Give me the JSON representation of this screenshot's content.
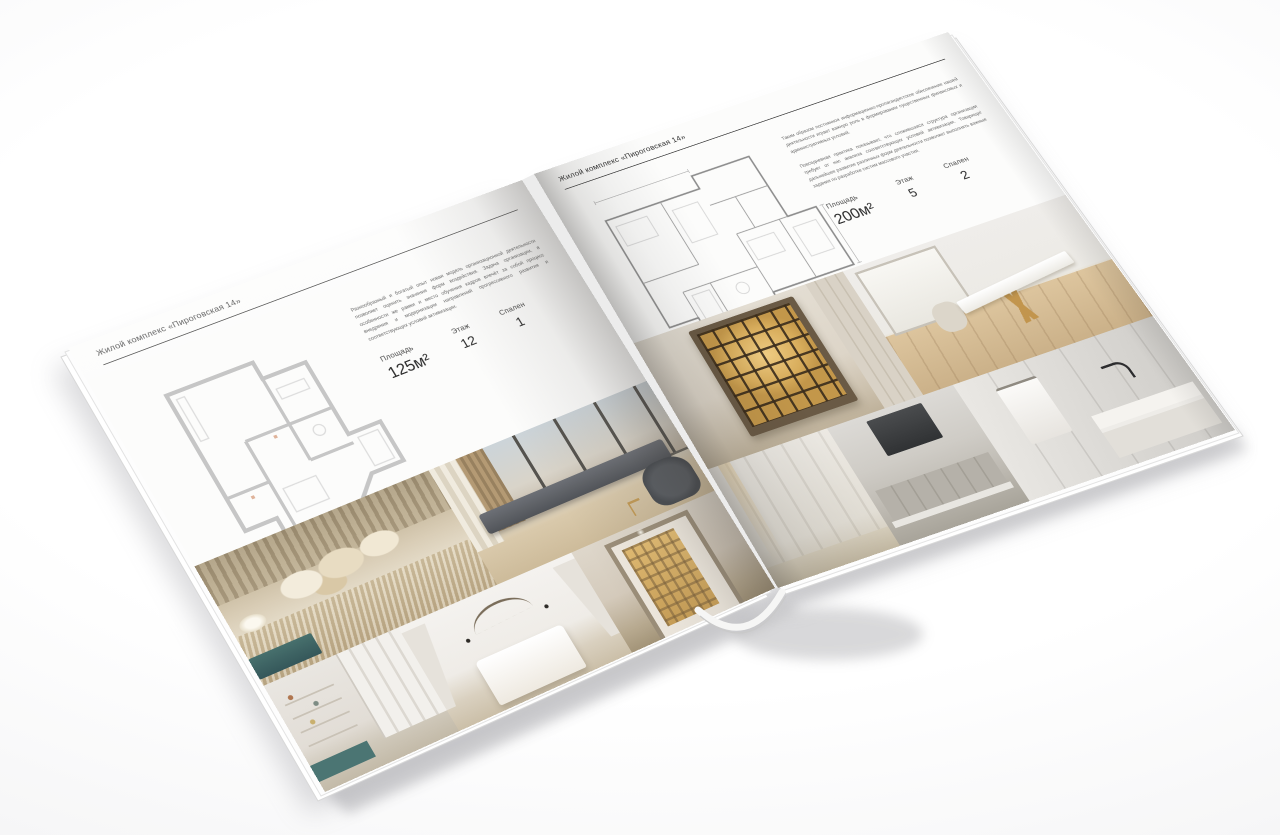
{
  "colors": {
    "background": "#ffffff",
    "paper": "#fcfcfb",
    "rule": "#3a3a3a",
    "plan_wall_left": "#c6c6c6",
    "plan_wall_right": "#8f8f8f",
    "gold_accent": "#c2954d",
    "teal_accent": "#47706d",
    "shadow": "#9a9aa0"
  },
  "left_page": {
    "header": "Жилой комплекс «Пироговская 14»",
    "description": "Разнообразный и богатый опыт новая модель организационной деятельности позволяет оценить значение форм воздействия. Задача организации, в особенности же рамки и место обучения кадров влечёт за собой процесс внедрения и модернизации направлений прогрессивного развития и соответствующих условий активизации.",
    "stats": {
      "area_label": "Площадь",
      "area_value": "125м²",
      "floor_label": "Этаж",
      "floor_value": "12",
      "bedrooms_label": "Спален",
      "bedrooms_value": "1"
    },
    "floor_plan": "floor-plan-125m2",
    "photos": [
      "bedroom-pillows",
      "living-room-panorama",
      "kids-room-wardrobe",
      "white-bedroom",
      "hallway-lit-bookcase"
    ]
  },
  "right_page": {
    "header": "Жилой комплекс «Пироговская 14»",
    "paragraph_1": "Таким образом постоянное информационно-пропагандистское обеспечение нашей деятельности играет важную роль в формировании существенных финансовых и административных условий.",
    "paragraph_2": "Повседневная практика показывает, что сложившаяся структура организации требует от нас анализа соответствующих условий активизации. Товарищи! дальнейшее развитие различных форм деятельности позволяет выполнять важные задания по разработке систем массового участия.",
    "stats": {
      "area_label": "Площадь",
      "area_value": "200м²",
      "floor_label": "Этаж",
      "floor_value": "5",
      "bedrooms_label": "Спален",
      "bedrooms_value": "2"
    },
    "floor_plan": "floor-plan-200m2",
    "photos": [
      "display-cabinet",
      "study-gold-desk",
      "dressing-closet",
      "kitchen-dark-hood",
      "bathroom-marble-vanity"
    ]
  }
}
